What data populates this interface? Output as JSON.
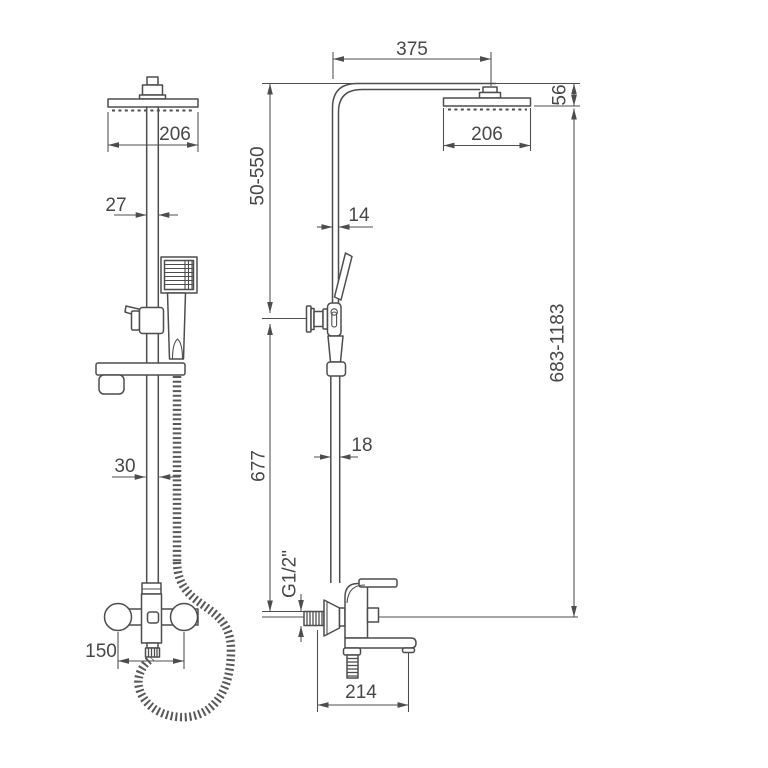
{
  "drawing": {
    "type": "shower-column-technical-drawing",
    "background": "#ffffff",
    "line_color": "#4d4d4d",
    "text_color": "#474747"
  },
  "dims": {
    "front_head_width": "206",
    "front_pipe_upper": "27",
    "front_pipe_lower": "30",
    "front_mount_spacing": "150",
    "side_arm_reach": "375",
    "side_head_depth": "206",
    "side_head_height": "56",
    "side_upper_range": "50-550",
    "side_pipe_upper": "14",
    "side_pipe_lower": "18",
    "side_riser_height": "677",
    "side_total_range": "683-1183",
    "side_thread": "G1/2\"",
    "side_spout_reach": "214"
  }
}
